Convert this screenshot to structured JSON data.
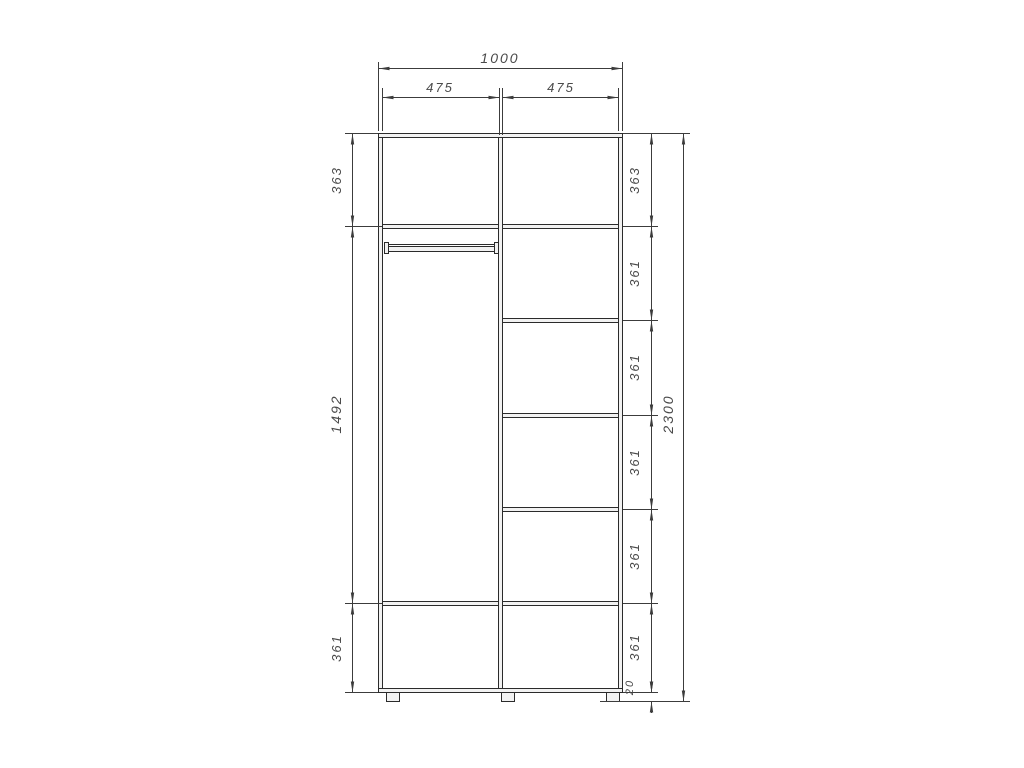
{
  "drawing": {
    "widths": {
      "overall": "1000",
      "left": "475",
      "right": "475"
    },
    "left_heights": [
      "363",
      "1492",
      "361"
    ],
    "right_heights": [
      "363",
      "361",
      "361",
      "361",
      "361",
      "361"
    ],
    "plinth_height": "20",
    "overall_height": "2300",
    "colors": {
      "cabinet_line": "#2b2b2b",
      "dim_line": "#3c3c3c",
      "text_color": "#4a4a4a",
      "panel_fill": "#f2f2f2"
    }
  }
}
